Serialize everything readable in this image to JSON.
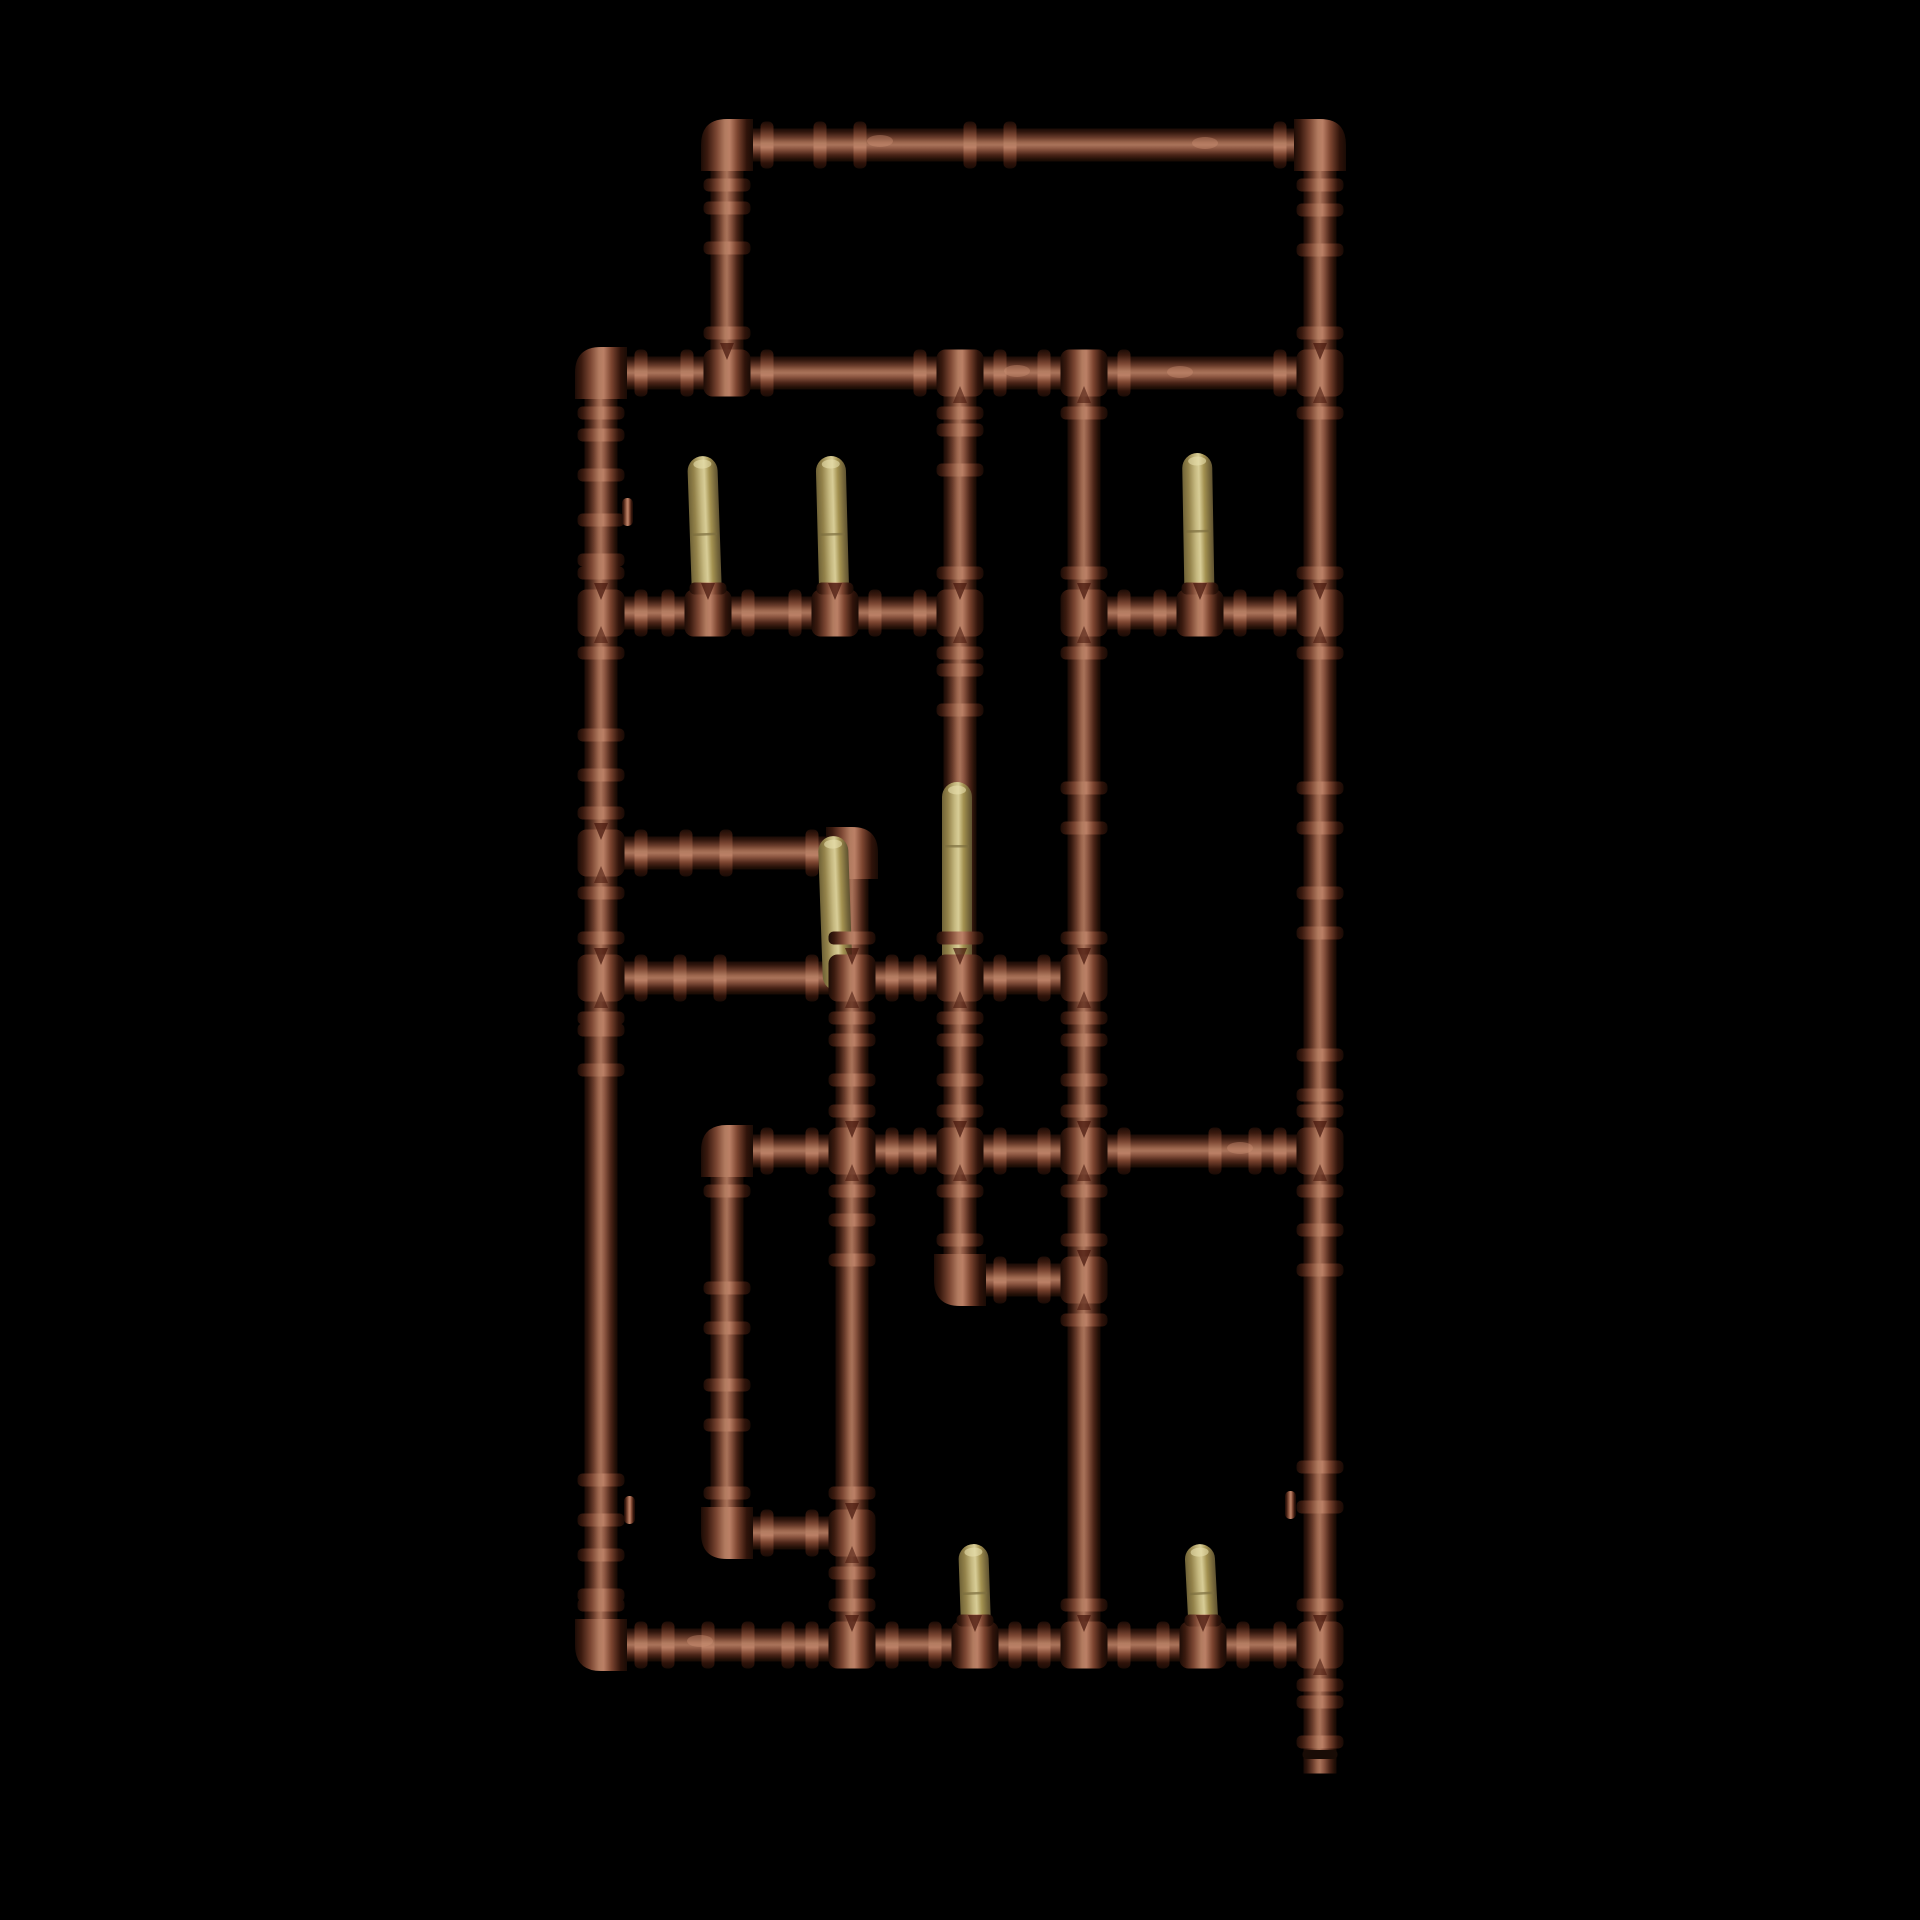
{
  "scene": {
    "subject": "copper pipe manifold 3d render with brass stub risers on black background",
    "background": "#000000",
    "canvas": {
      "width": 1920,
      "height": 1920
    },
    "geometry": {
      "pipe_w": 33,
      "fit_w": 47,
      "collar_len": 13,
      "collar_off": 40,
      "ring_gap": 20,
      "corner": 52,
      "corner_r": 26,
      "brass_w": 30
    },
    "colors": {
      "copper_stops": [
        [
          0,
          "#1a0b06"
        ],
        [
          0.1,
          "#2f150c"
        ],
        [
          0.28,
          "#6b3d2c"
        ],
        [
          0.42,
          "#9c664d"
        ],
        [
          0.5,
          "#a9735a"
        ],
        [
          0.62,
          "#8a5440"
        ],
        [
          0.8,
          "#4a2417"
        ],
        [
          0.93,
          "#241007"
        ],
        [
          1,
          "#170a04"
        ]
      ],
      "fitting_stops": [
        [
          0,
          "#1d0c06"
        ],
        [
          0.12,
          "#3a1a0f"
        ],
        [
          0.3,
          "#7c4733"
        ],
        [
          0.46,
          "#b27b60"
        ],
        [
          0.55,
          "#bb8066"
        ],
        [
          0.7,
          "#7c4530"
        ],
        [
          0.88,
          "#2f130a"
        ],
        [
          1,
          "#1a0b05"
        ]
      ],
      "brass_stops": [
        [
          0,
          "#6f6236"
        ],
        [
          0.2,
          "#93824a"
        ],
        [
          0.42,
          "#c5b87f"
        ],
        [
          0.55,
          "#d8cd97"
        ],
        [
          0.72,
          "#a39150"
        ],
        [
          0.9,
          "#75663a"
        ],
        [
          1,
          "#5f5230"
        ]
      ],
      "brass_cap": "#e8dfae",
      "brass_seam": "#7c6d3e",
      "solder": "#43140a",
      "shine": "#cf9377",
      "end_cap": "#190c06"
    },
    "pipes_h": [
      {
        "x1": 727,
        "x2": 1320,
        "y": 145
      },
      {
        "x1": 601,
        "x2": 1320,
        "y": 373
      },
      {
        "x1": 601,
        "x2": 960,
        "y": 613
      },
      {
        "x1": 1084,
        "x2": 1320,
        "y": 613
      },
      {
        "x1": 601,
        "x2": 852,
        "y": 853
      },
      {
        "x1": 601,
        "x2": 1084,
        "y": 978
      },
      {
        "x1": 727,
        "x2": 1320,
        "y": 1151
      },
      {
        "x1": 960,
        "x2": 1084,
        "y": 1280
      },
      {
        "x1": 727,
        "x2": 852,
        "y": 1533
      },
      {
        "x1": 601,
        "x2": 1320,
        "y": 1645
      }
    ],
    "pipes_v": [
      {
        "x": 601,
        "y1": 373,
        "y2": 1645
      },
      {
        "x": 727,
        "y1": 145,
        "y2": 373
      },
      {
        "x": 960,
        "y1": 373,
        "y2": 1280
      },
      {
        "x": 1084,
        "y1": 373,
        "y2": 1645
      },
      {
        "x": 852,
        "y1": 853,
        "y2": 1645
      },
      {
        "x": 727,
        "y1": 1151,
        "y2": 1533
      },
      {
        "x": 1320,
        "y1": 145,
        "y2": 1757
      }
    ],
    "elbows": [
      {
        "x": 727,
        "y": 145,
        "legs": "ES"
      },
      {
        "x": 1320,
        "y": 145,
        "legs": "WS"
      },
      {
        "x": 601,
        "y": 373,
        "legs": "ES"
      },
      {
        "x": 601,
        "y": 1645,
        "legs": "EN"
      },
      {
        "x": 852,
        "y": 853,
        "legs": "WS",
        "collars": "W"
      },
      {
        "x": 727,
        "y": 1151,
        "legs": "ES"
      },
      {
        "x": 960,
        "y": 1280,
        "legs": "EN"
      },
      {
        "x": 727,
        "y": 1533,
        "legs": "EN"
      }
    ],
    "junctions": [
      {
        "x": 727,
        "y": 373,
        "arms": "WEN"
      },
      {
        "x": 960,
        "y": 373,
        "arms": "WES"
      },
      {
        "x": 1084,
        "y": 373,
        "arms": "WES"
      },
      {
        "x": 1320,
        "y": 373,
        "arms": "WNS"
      },
      {
        "x": 601,
        "y": 613,
        "arms": "ENS"
      },
      {
        "x": 708,
        "y": 613,
        "arms": "WEN",
        "stub": true
      },
      {
        "x": 835,
        "y": 613,
        "arms": "WEN",
        "stub": true
      },
      {
        "x": 960,
        "y": 613,
        "arms": "WNS"
      },
      {
        "x": 1084,
        "y": 613,
        "arms": "ENS"
      },
      {
        "x": 1200,
        "y": 613,
        "arms": "WEN",
        "stub": true
      },
      {
        "x": 1320,
        "y": 613,
        "arms": "WNS"
      },
      {
        "x": 601,
        "y": 853,
        "arms": "ENS"
      },
      {
        "x": 601,
        "y": 978,
        "arms": "ENS"
      },
      {
        "x": 852,
        "y": 978,
        "arms": "WENS"
      },
      {
        "x": 960,
        "y": 978,
        "arms": "WENS"
      },
      {
        "x": 1084,
        "y": 978,
        "arms": "WNS"
      },
      {
        "x": 852,
        "y": 1151,
        "arms": "WENS"
      },
      {
        "x": 960,
        "y": 1151,
        "arms": "WENS"
      },
      {
        "x": 1084,
        "y": 1151,
        "arms": "WENS"
      },
      {
        "x": 1320,
        "y": 1151,
        "arms": "WNS"
      },
      {
        "x": 1084,
        "y": 1280,
        "arms": "WNS"
      },
      {
        "x": 852,
        "y": 1533,
        "arms": "WNS"
      },
      {
        "x": 852,
        "y": 1645,
        "arms": "WEN"
      },
      {
        "x": 975,
        "y": 1645,
        "arms": "WEN",
        "stub": true
      },
      {
        "x": 1084,
        "y": 1645,
        "arms": "WEN"
      },
      {
        "x": 1203,
        "y": 1645,
        "arms": "WEN",
        "stub": true
      },
      {
        "x": 1320,
        "y": 1645,
        "arms": "WNS"
      }
    ],
    "stubs": [
      {
        "x": 708,
        "top": 456,
        "base": 625,
        "tilt": -2,
        "seam": 533
      },
      {
        "x": 835,
        "top": 456,
        "base": 625,
        "tilt": -1.5,
        "seam": 533
      },
      {
        "x": 1200,
        "top": 453,
        "base": 625,
        "tilt": -1,
        "seam": 530
      },
      {
        "x": 838,
        "top": 836,
        "base": 985,
        "tilt": -2
      },
      {
        "x": 957,
        "top": 782,
        "base": 985,
        "tilt": 0,
        "seam": 845
      },
      {
        "x": 977,
        "top": 1544,
        "base": 1655,
        "tilt": -2,
        "seam": 1592
      },
      {
        "x": 1205,
        "top": 1544,
        "base": 1655,
        "tilt": -3,
        "seam": 1592
      }
    ],
    "couplings_h": [
      [
        840,
        145
      ],
      [
        990,
        145
      ],
      [
        706,
        853
      ],
      [
        700,
        978
      ],
      [
        1235,
        1151
      ],
      [
        688,
        1645
      ],
      [
        768,
        1645
      ]
    ],
    "couplings_v": [
      [
        601,
        455
      ],
      [
        601,
        540
      ],
      [
        601,
        755
      ],
      [
        601,
        1050
      ],
      [
        601,
        1500
      ],
      [
        601,
        1575
      ],
      [
        727,
        228
      ],
      [
        960,
        450
      ],
      [
        960,
        690
      ],
      [
        960,
        1060
      ],
      [
        1084,
        808
      ],
      [
        1084,
        1060
      ],
      [
        852,
        1060
      ],
      [
        852,
        1240
      ],
      [
        727,
        1308
      ],
      [
        727,
        1405
      ],
      [
        1320,
        230
      ],
      [
        1320,
        808
      ],
      [
        1320,
        913
      ],
      [
        1320,
        1075
      ],
      [
        1320,
        1250
      ],
      [
        1320,
        1487
      ],
      [
        1320,
        1722
      ]
    ],
    "bumps": [
      {
        "x": 622,
        "y": 512,
        "side": "e"
      },
      {
        "x": 624,
        "y": 1510,
        "side": "e"
      },
      {
        "x": 1296,
        "y": 1505,
        "side": "w"
      }
    ],
    "shines": [
      [
        880,
        141
      ],
      [
        1205,
        143
      ],
      [
        1017,
        371
      ],
      [
        1180,
        372
      ],
      [
        700,
        1641
      ],
      [
        1240,
        1148
      ]
    ],
    "cap": {
      "x": 1320,
      "y": 1750
    }
  }
}
